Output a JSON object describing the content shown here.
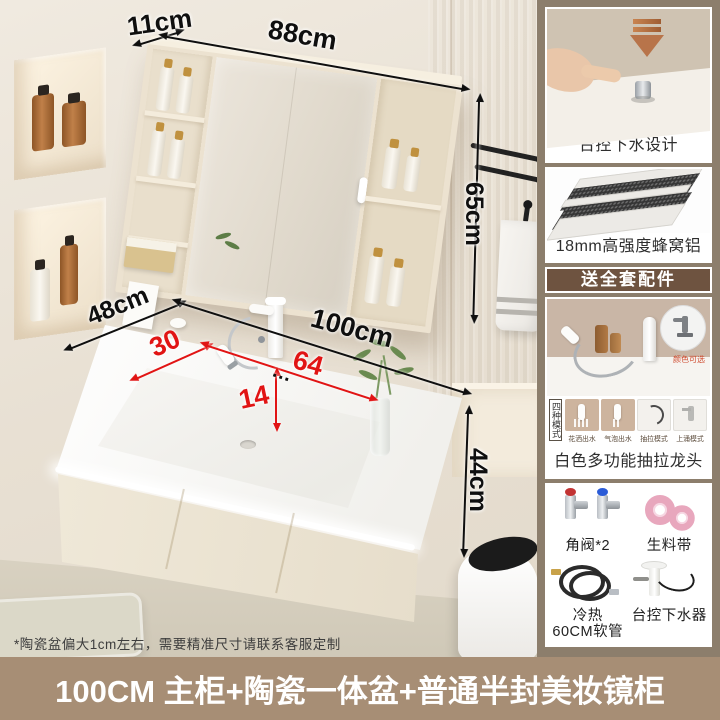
{
  "colors": {
    "banner_bg": "#a78e75",
    "sidebar_bg": "#8c7e6c",
    "gift_strip_bg": "#6e5340",
    "accent_red": "#e11414",
    "bronze": "#b8744a"
  },
  "annotations": {
    "mirror_top_depth": "11cm",
    "mirror_width": "88cm",
    "mirror_height": "65cm",
    "counter_depth": "48cm",
    "counter_width": "100cm",
    "basin_left_width": "30",
    "basin_right_width": "64",
    "basin_depth": "14",
    "cabinet_height": "44cm",
    "dots": "…"
  },
  "disclaimer": "*陶瓷盆偏大1cm左右，需要精准尺寸请联系客服定制",
  "banner": {
    "title": "100CM 主柜+陶瓷一体盆+普通半封美妆镜柜"
  },
  "sidebar": {
    "card1_label": "台控下水设计",
    "card2_label": "18mm高强度蜂窝铝",
    "gift_banner": "送全套配件",
    "color_note": "颜色可选",
    "modes_title": "四种模式",
    "modes": [
      "花洒出水",
      "气泡出水",
      "抽拉模式",
      "上涌模式"
    ],
    "faucet_label": "白色多功能抽拉龙头",
    "accessories": [
      {
        "line1": "角阀*2",
        "line2": ""
      },
      {
        "line1": "生料带",
        "line2": ""
      },
      {
        "line1": "冷热",
        "line2": "60CM软管"
      },
      {
        "line1": "台控下水器",
        "line2": ""
      }
    ],
    "icons": {
      "press_down": "bronze-down-arrow",
      "honeycomb": "layered-panels",
      "color_inset": "gray-faucet-circle"
    }
  }
}
